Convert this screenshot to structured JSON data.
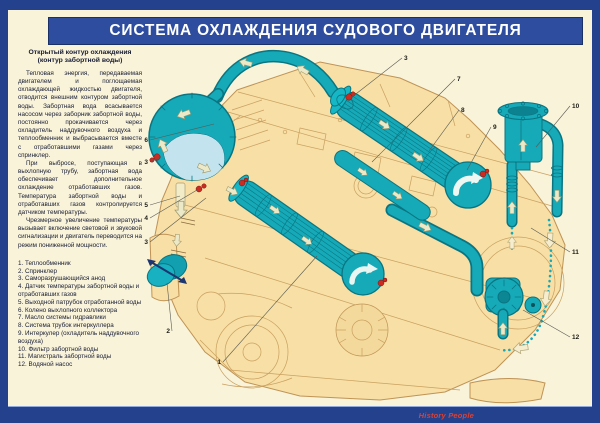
{
  "page": {
    "title": "СИСТЕМА ОХЛАЖДЕНИЯ СУДОВОГО ДВИГАТЕЛЯ"
  },
  "sidebar": {
    "heading_line1": "Открытый контур охлаждения",
    "heading_line2": "(контур забортной воды)",
    "paragraphs": [
      "Тепловая энергия, передаваемая двигателем и поглощаемая охлаждающей жидкостью двигателя, отводится внешним контуром забортной воды. Забортная вода всасывается насосом через заборник забортной воды, постоянно прокачивается через охладитель наддувочного воздуха и теплообменник и выбрасывается вместе с отработавшими газами через спринклер.",
      "При выбросе, поступающая в выхлопную трубу, забортная вода обеспечивает дополнительное охлаждение отработавших газов. Температура забортной воды и отработавших газов контролируется датчиком температуры.",
      "Чрезмерное увеличение температуры вызывает включение световой и звуковой сигнализации и двигатель переводится на режим пониженной мощности."
    ],
    "legend": [
      "1. Теплообменник",
      "2. Спринклер",
      "3. Саморазрушающийся анод",
      "4. Датчик температуры забортной воды и отработавших газов",
      "5. Выходной патрубок отработанной воды",
      "6. Колено выхлопного коллектора",
      "7. Масло системы гидравлики",
      "8. Система трубок интеркуллера",
      "9. Интеркулер (охладитель наддувочного воздуха)",
      "10. Фильтр забортной воды",
      "11. Магистраль забортной воды",
      "12. Водяной насос"
    ]
  },
  "diagram": {
    "callouts": [
      {
        "n": "6",
        "lx": 148,
        "ly": 142,
        "tx": 214,
        "ty": 124,
        "anchor": "end"
      },
      {
        "n": "3",
        "lx": 148,
        "ly": 164,
        "tx": 159,
        "ty": 158,
        "anchor": "end"
      },
      {
        "n": "5",
        "lx": 148,
        "ly": 207,
        "tx": 180,
        "ty": 196,
        "anchor": "end"
      },
      {
        "n": "4",
        "lx": 148,
        "ly": 220,
        "tx": 197,
        "ty": 190,
        "anchor": "end"
      },
      {
        "n": "3",
        "lx": 148,
        "ly": 244,
        "tx": 206,
        "ty": 198,
        "anchor": "end"
      },
      {
        "n": "2",
        "lx": 170,
        "ly": 333,
        "tx": 167,
        "ty": 283,
        "anchor": "end"
      },
      {
        "n": "1",
        "lx": 221,
        "ly": 364,
        "tx": 317,
        "ty": 256,
        "anchor": "end"
      },
      {
        "n": "3",
        "lx": 404,
        "ly": 60,
        "tx": 352,
        "ty": 97,
        "anchor": "start"
      },
      {
        "n": "7",
        "lx": 457,
        "ly": 81,
        "tx": 372,
        "ty": 162,
        "anchor": "start"
      },
      {
        "n": "8",
        "lx": 461,
        "ly": 112,
        "tx": 429,
        "ty": 151,
        "anchor": "start"
      },
      {
        "n": "9",
        "lx": 493,
        "ly": 129,
        "tx": 467,
        "ty": 170,
        "anchor": "start"
      },
      {
        "n": "10",
        "lx": 572,
        "ly": 108,
        "tx": 536,
        "ty": 147,
        "anchor": "start"
      },
      {
        "n": "11",
        "lx": 572,
        "ly": 254,
        "tx": 531,
        "ty": 228,
        "anchor": "start"
      },
      {
        "n": "12",
        "lx": 572,
        "ly": 339,
        "tx": 523,
        "ty": 310,
        "anchor": "start"
      }
    ]
  },
  "footer": {
    "logo_text": "History People"
  },
  "colors": {
    "border": "#24418e",
    "background": "#f9f3da",
    "banner": "#2e4d9e",
    "engine": "#f7dfa5",
    "pipe": "#16a9b8",
    "pipe_dark": "#0a7581",
    "anode_red": "#cc2b21",
    "ink": "#171c33",
    "logo_red": "#e0402e"
  }
}
